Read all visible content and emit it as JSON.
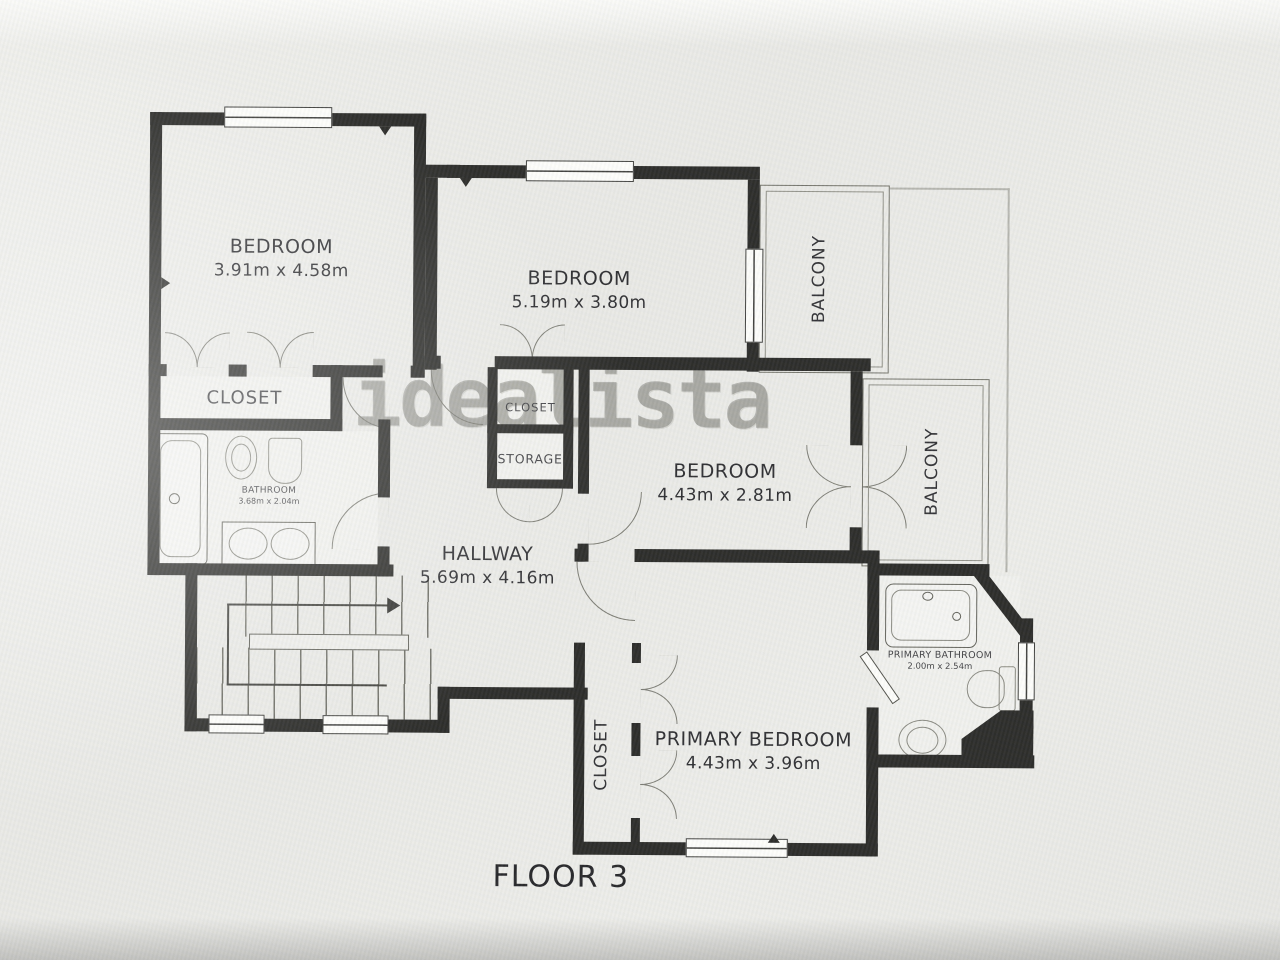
{
  "title": "FLOOR 3",
  "watermark": "idealista",
  "rooms": {
    "bedroom1": {
      "label": "BEDROOM",
      "dims": "3.91m x 4.58m"
    },
    "bedroom2": {
      "label": "BEDROOM",
      "dims": "5.19m x 3.80m"
    },
    "bedroom3": {
      "label": "BEDROOM",
      "dims": "4.43m x 2.81m"
    },
    "primary_bedroom": {
      "label": "PRIMARY BEDROOM",
      "dims": "4.43m x 3.96m"
    },
    "hallway": {
      "label": "HALLWAY",
      "dims": "5.69m x 4.16m"
    },
    "bathroom": {
      "label": "BATHROOM",
      "dims": "3.68m x 2.04m"
    },
    "primary_bathroom": {
      "label": "PRIMARY BATHROOM",
      "dims": "2.00m x 2.54m"
    },
    "closet_bedroom1": {
      "label": "CLOSET"
    },
    "closet_hall": {
      "label": "CLOSET"
    },
    "storage": {
      "label": "STORAGE"
    },
    "closet_primary": {
      "label": "CLOSET"
    },
    "balcony_top": {
      "label": "BALCONY"
    },
    "balcony_right": {
      "label": "BALCONY"
    }
  },
  "colors": {
    "wall": "#232321",
    "floor": "#e9e9e6",
    "thin_line": "#6e6e66",
    "watermark": "#767670"
  }
}
